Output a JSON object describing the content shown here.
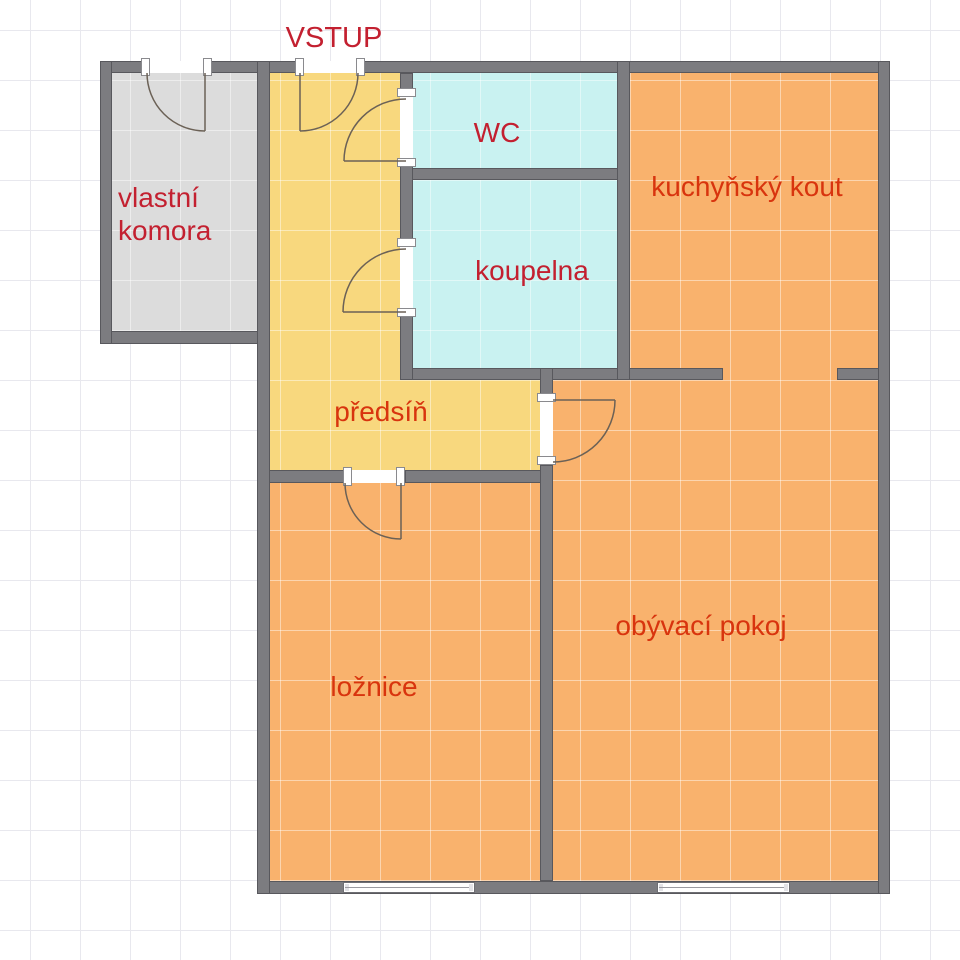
{
  "plan": {
    "entrance_label": "VSTUP",
    "rooms": {
      "komora": {
        "label": "vlastní\nkomora"
      },
      "wc": {
        "label": "WC"
      },
      "koupelna": {
        "label": "koupelna"
      },
      "kuchynsky_kout": {
        "label": "kuchyňský kout"
      },
      "predsin": {
        "label": "předsíň"
      },
      "loznice": {
        "label": "ložnice"
      },
      "obyvaci_pokoj": {
        "label": "obývací pokoj"
      }
    },
    "colors": {
      "wall_gray": "#7c7c80",
      "komora_fill": "#dcdcdc",
      "hall_fill": "#f8d87e",
      "bath_fill": "#c9f2f1",
      "room_fill": "#f9b26d",
      "label_red_cool": "#c32030",
      "label_red_warm": "#d8340e",
      "grid_line": "#e8e8ee"
    }
  }
}
